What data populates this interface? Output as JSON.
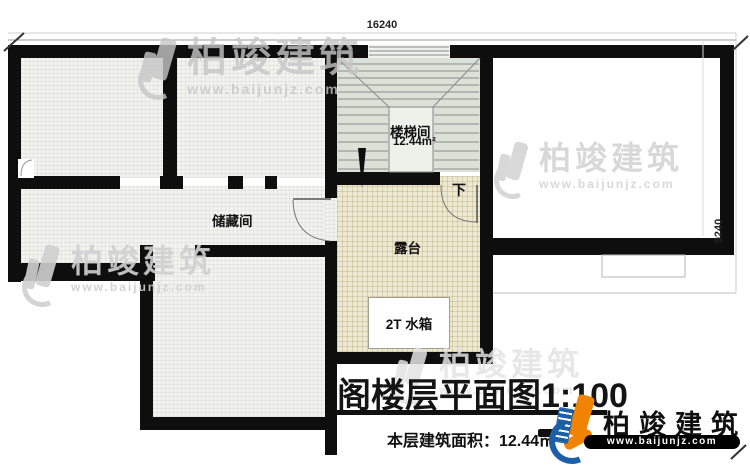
{
  "annotations": {
    "dim_top": "16240",
    "dim_right": "9240"
  },
  "rooms": {
    "storage_label": "储藏间",
    "stair_label": "楼梯间",
    "stair_area": "12.44m²",
    "terrace_label": "露台",
    "tank_label": "2T 水箱",
    "direction_label": "下"
  },
  "title_block": {
    "title": "阁楼层平面图1:100",
    "area_line": "本层建筑面积：12.44㎡"
  },
  "branding": {
    "name": "柏竣建筑",
    "url": "www.baijunjz.com"
  },
  "watermark": {
    "name": "柏竣建筑",
    "url": "www.baijunjz.com"
  },
  "colors": {
    "wall": "#0e0e0e",
    "logo_orange": "#f08300",
    "logo_blue": "#1d5fa6",
    "terrace_floor": "#ede8d2",
    "stair_floor": "#dce1d8"
  }
}
